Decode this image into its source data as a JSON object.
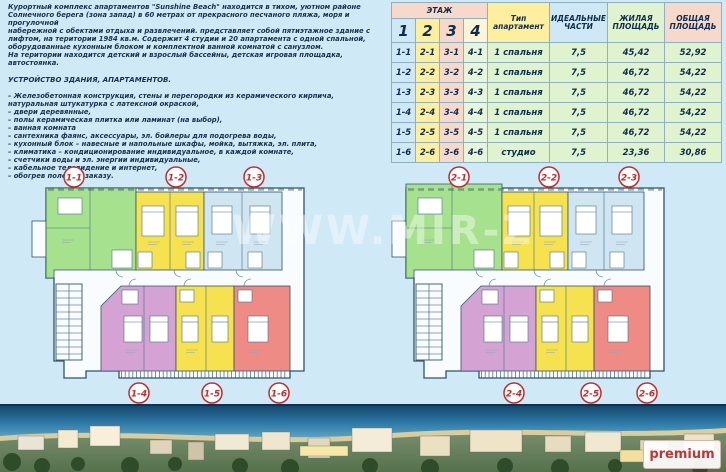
{
  "page": {
    "watermark": "WWW.MIR-Z",
    "background": "#cfe9f7",
    "accent_red": "#c32b2b"
  },
  "intro": {
    "lines": [
      "Курортный комплекс апартаментов \"Sunshine Beach\" находится в тихом, уютном районе",
      "Солнечного берега (зона запад) в 60 метрах от прекрасного песчаного пляжа, моря и прогулочной",
      "набережной с обектами отдыха и развлечений. представляет собой пятиэтажное здание с",
      "лифтом, на територии 1984 кв.м. Содержит 4 студии и 20 апартамента с одной спальной,",
      "оборудованные кухонным блоком и комплектной ванной комнатой с санузлом.",
      "На територии находится детский и взрослый бассейны, детская игровая площадка, автостоянка."
    ],
    "heading": "УСТРОЙСТВО ЗДАНИЯ, АПАРТАМЕНТОВ.",
    "bullets": [
      "– Железобетонная конструкция, стены и перегородки из керамического кирпича,",
      "натуральная штукатурка с латексной окраской,",
      "– двери деревянные,",
      "– полы керамическая плитка или ламинат (на выбор),",
      "– ванная комната",
      "– сантехника фаянс, аксессуары, эл. бойлеры для подогрева воды,",
      "– кухонный блок – навесные и напольные шкафы, мойка, вытяжка, эл. плита,",
      "– климатика –  кондиционирование индивидуальное, в каждой комнате,",
      "– счетчики воды и эл. энергии индивидуальные,",
      "– кабельное телевидение и интернет,",
      "– обогрев полов по заказу."
    ]
  },
  "table": {
    "floor_header": "ЭТАЖ",
    "floor_numbers": [
      "1",
      "2",
      "3",
      "4"
    ],
    "col_type": "Тип апартамент",
    "col_ideal": "ИДЕАЛЬНЫЕ ЧАСТИ",
    "col_living": "ЖИЛАЯ ПЛОЩАДЬ",
    "col_total": "ОБЩАЯ ПЛОЩАДЬ",
    "rows": [
      {
        "c1": "1-1",
        "c2": "2-1",
        "c3": "3-1",
        "c4": "4-1",
        "type": "1 спальня",
        "ideal": "7,5",
        "living": "45,42",
        "total": "52,92"
      },
      {
        "c1": "1-2",
        "c2": "2-2",
        "c3": "3-2",
        "c4": "4-2",
        "type": "1 спальня",
        "ideal": "7,5",
        "living": "46,72",
        "total": "54,22"
      },
      {
        "c1": "1-3",
        "c2": "2-3",
        "c3": "3-3",
        "c4": "4-3",
        "type": "1 спальня",
        "ideal": "7,5",
        "living": "46,72",
        "total": "54,22"
      },
      {
        "c1": "1-4",
        "c2": "2-4",
        "c3": "3-4",
        "c4": "4-4",
        "type": "1 спальня",
        "ideal": "7,5",
        "living": "46,72",
        "total": "54,22"
      },
      {
        "c1": "1-5",
        "c2": "2-5",
        "c3": "3-5",
        "c4": "4-5",
        "type": "1 спальня",
        "ideal": "7,5",
        "living": "46,72",
        "total": "54,22"
      },
      {
        "c1": "1-6",
        "c2": "2-6",
        "c3": "3-6",
        "c4": "4-6",
        "type": "студио",
        "ideal": "7,5",
        "living": "23,36",
        "total": "30,86"
      }
    ]
  },
  "plans": [
    {
      "labels_top": [
        "1-1",
        "1-2",
        "1-3"
      ],
      "labels_bottom": [
        "1-4",
        "1-5",
        "1-6"
      ]
    },
    {
      "labels_top": [
        "2-1",
        "2-2",
        "2-3"
      ],
      "labels_bottom": [
        "2-4",
        "2-5",
        "2-6"
      ]
    }
  ],
  "plan_colors": {
    "apt_green": "#a6e28e",
    "apt_yellow": "#f6e24e",
    "apt_blue": "#cfe6f2",
    "apt_purple": "#d4a3d4",
    "apt_red": "#ef8b85",
    "line": "#2f546c"
  },
  "photo": {
    "logo": "premium"
  }
}
